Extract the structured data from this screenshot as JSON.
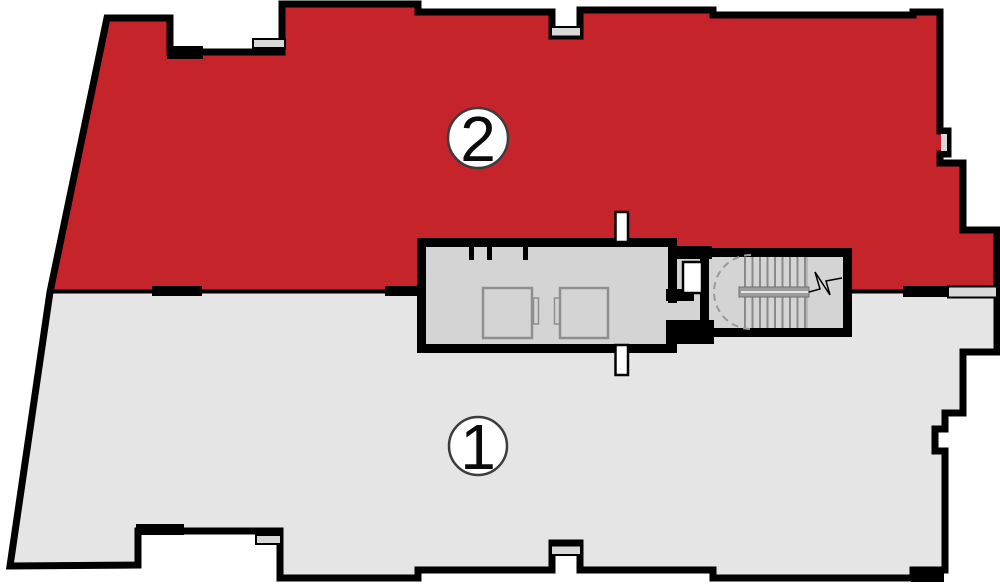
{
  "plan": {
    "units": [
      {
        "label": "2",
        "fill": "#c5242b"
      },
      {
        "label": "1",
        "fill": "#e4e5e4"
      }
    ]
  },
  "colors": {
    "background": "#ffffff",
    "wall": "#000000",
    "core_fill": "#d3d4d3",
    "sill_fill": "#d8d8d8",
    "shaft_fill": "#ffffff",
    "rail_fill": "#9c9c9c",
    "elevator_stroke": "#8f8f8f",
    "tread_stroke": "#8a8a8a",
    "swing_dash_stroke": "#9a9a9a",
    "badge_fill": "#ffffff",
    "badge_stroke": "#3c3c3c"
  }
}
